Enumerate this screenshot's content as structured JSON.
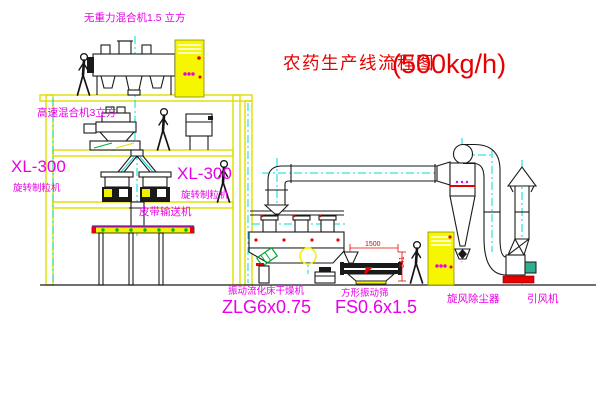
{
  "title": {
    "text": "农药生产线流程图",
    "capacity": "(500kg/h)"
  },
  "labels": {
    "top_mixer": "无重力混合机1.5 立方",
    "high_speed_mixer": "高速混合机3立方",
    "granulator_left": {
      "model": "XL-300",
      "name": "旋转制粒机"
    },
    "granulator_right": {
      "model": "XL-300",
      "name": "旋转制粒机"
    },
    "belt_conveyor": "皮带输送机",
    "dryer": {
      "name": "振动流化床干燥机",
      "model": "ZLG6x0.75"
    },
    "sieve": {
      "name": "方形振动筛",
      "model": "FS0.6x1.5"
    },
    "cyclone": "旋风除尘器",
    "fan": "引风机"
  },
  "dimensions": {
    "sieve_width": "1500",
    "sieve_height": "341"
  },
  "colors": {
    "title_red": "#e60000",
    "label_magenta": "#e800e8",
    "frame_yellow": "#dede00",
    "cabinet_yellow": "#f6f600",
    "centerline_cyan": "#00d9d9",
    "conveyor_dot_green": "#00b400",
    "drum_green": "#00a830",
    "motor_teal": "#2fae8f",
    "line_black": "#1a1a1a"
  }
}
